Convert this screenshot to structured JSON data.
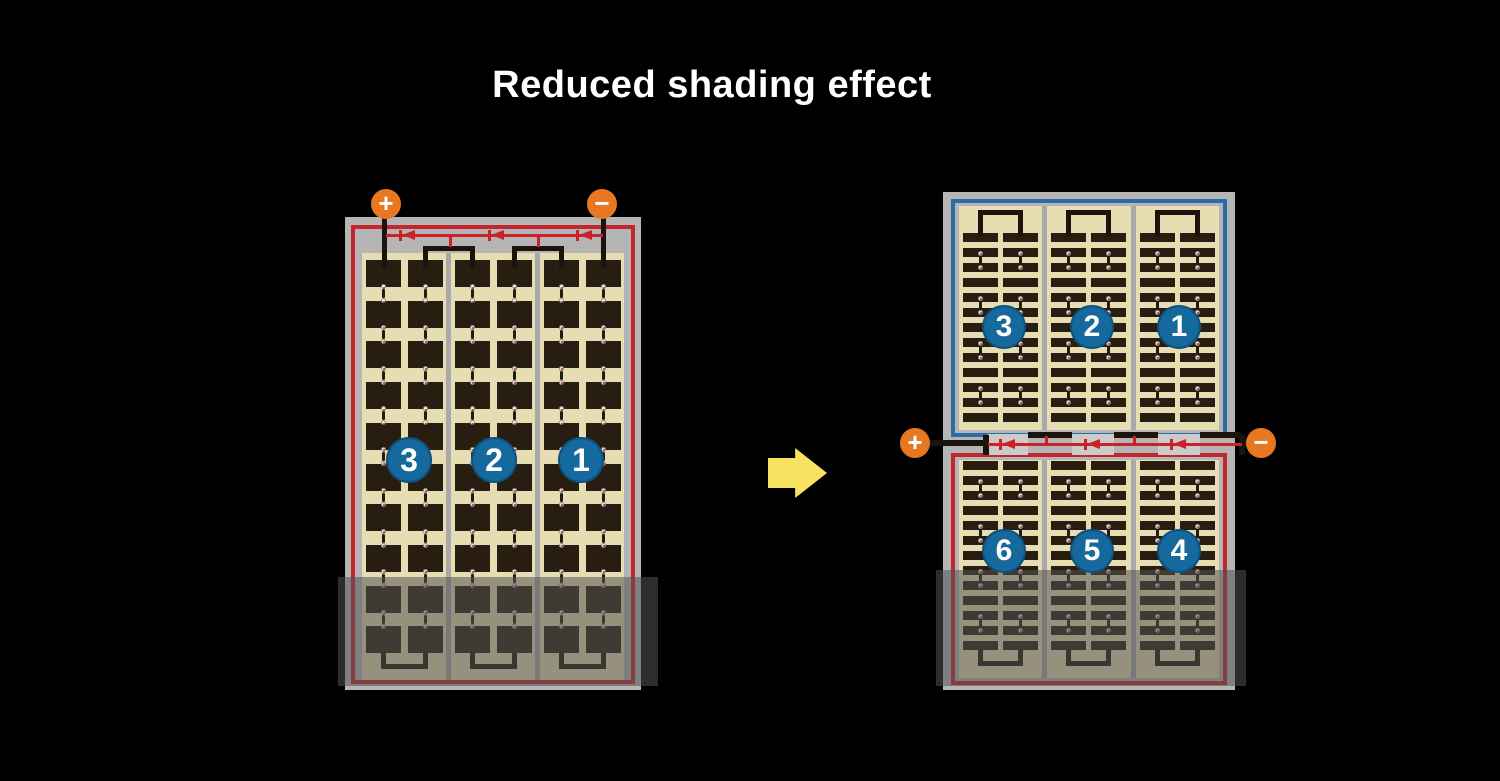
{
  "title": "Reduced shading effect",
  "colors": {
    "background": "#000000",
    "title_text": "#ffffff",
    "frame_gray": "#b5b5b6",
    "cell_area_cream": "#e7ddb2",
    "cell_dark": "#281d11",
    "border_red": "#c3272b",
    "border_blue": "#2a6ca6",
    "diode_red": "#cc2127",
    "terminal_orange": "#e87722",
    "badge_blue": "#15699d",
    "arrow_yellow": "#f8e161",
    "busbar_black": "#1c140c",
    "separator_gray": "#a9a9ab",
    "junction_box_gray": "#cbcbcb",
    "shade_overlay": "rgba(82,82,82,0.55)"
  },
  "left_panel": {
    "terminal_plus": "+",
    "terminal_minus": "−",
    "string_labels": [
      "3",
      "2",
      "1"
    ]
  },
  "right_panel": {
    "terminal_plus": "+",
    "terminal_minus": "−",
    "top_string_labels": [
      "3",
      "2",
      "1"
    ],
    "bottom_string_labels": [
      "6",
      "5",
      "4"
    ]
  }
}
